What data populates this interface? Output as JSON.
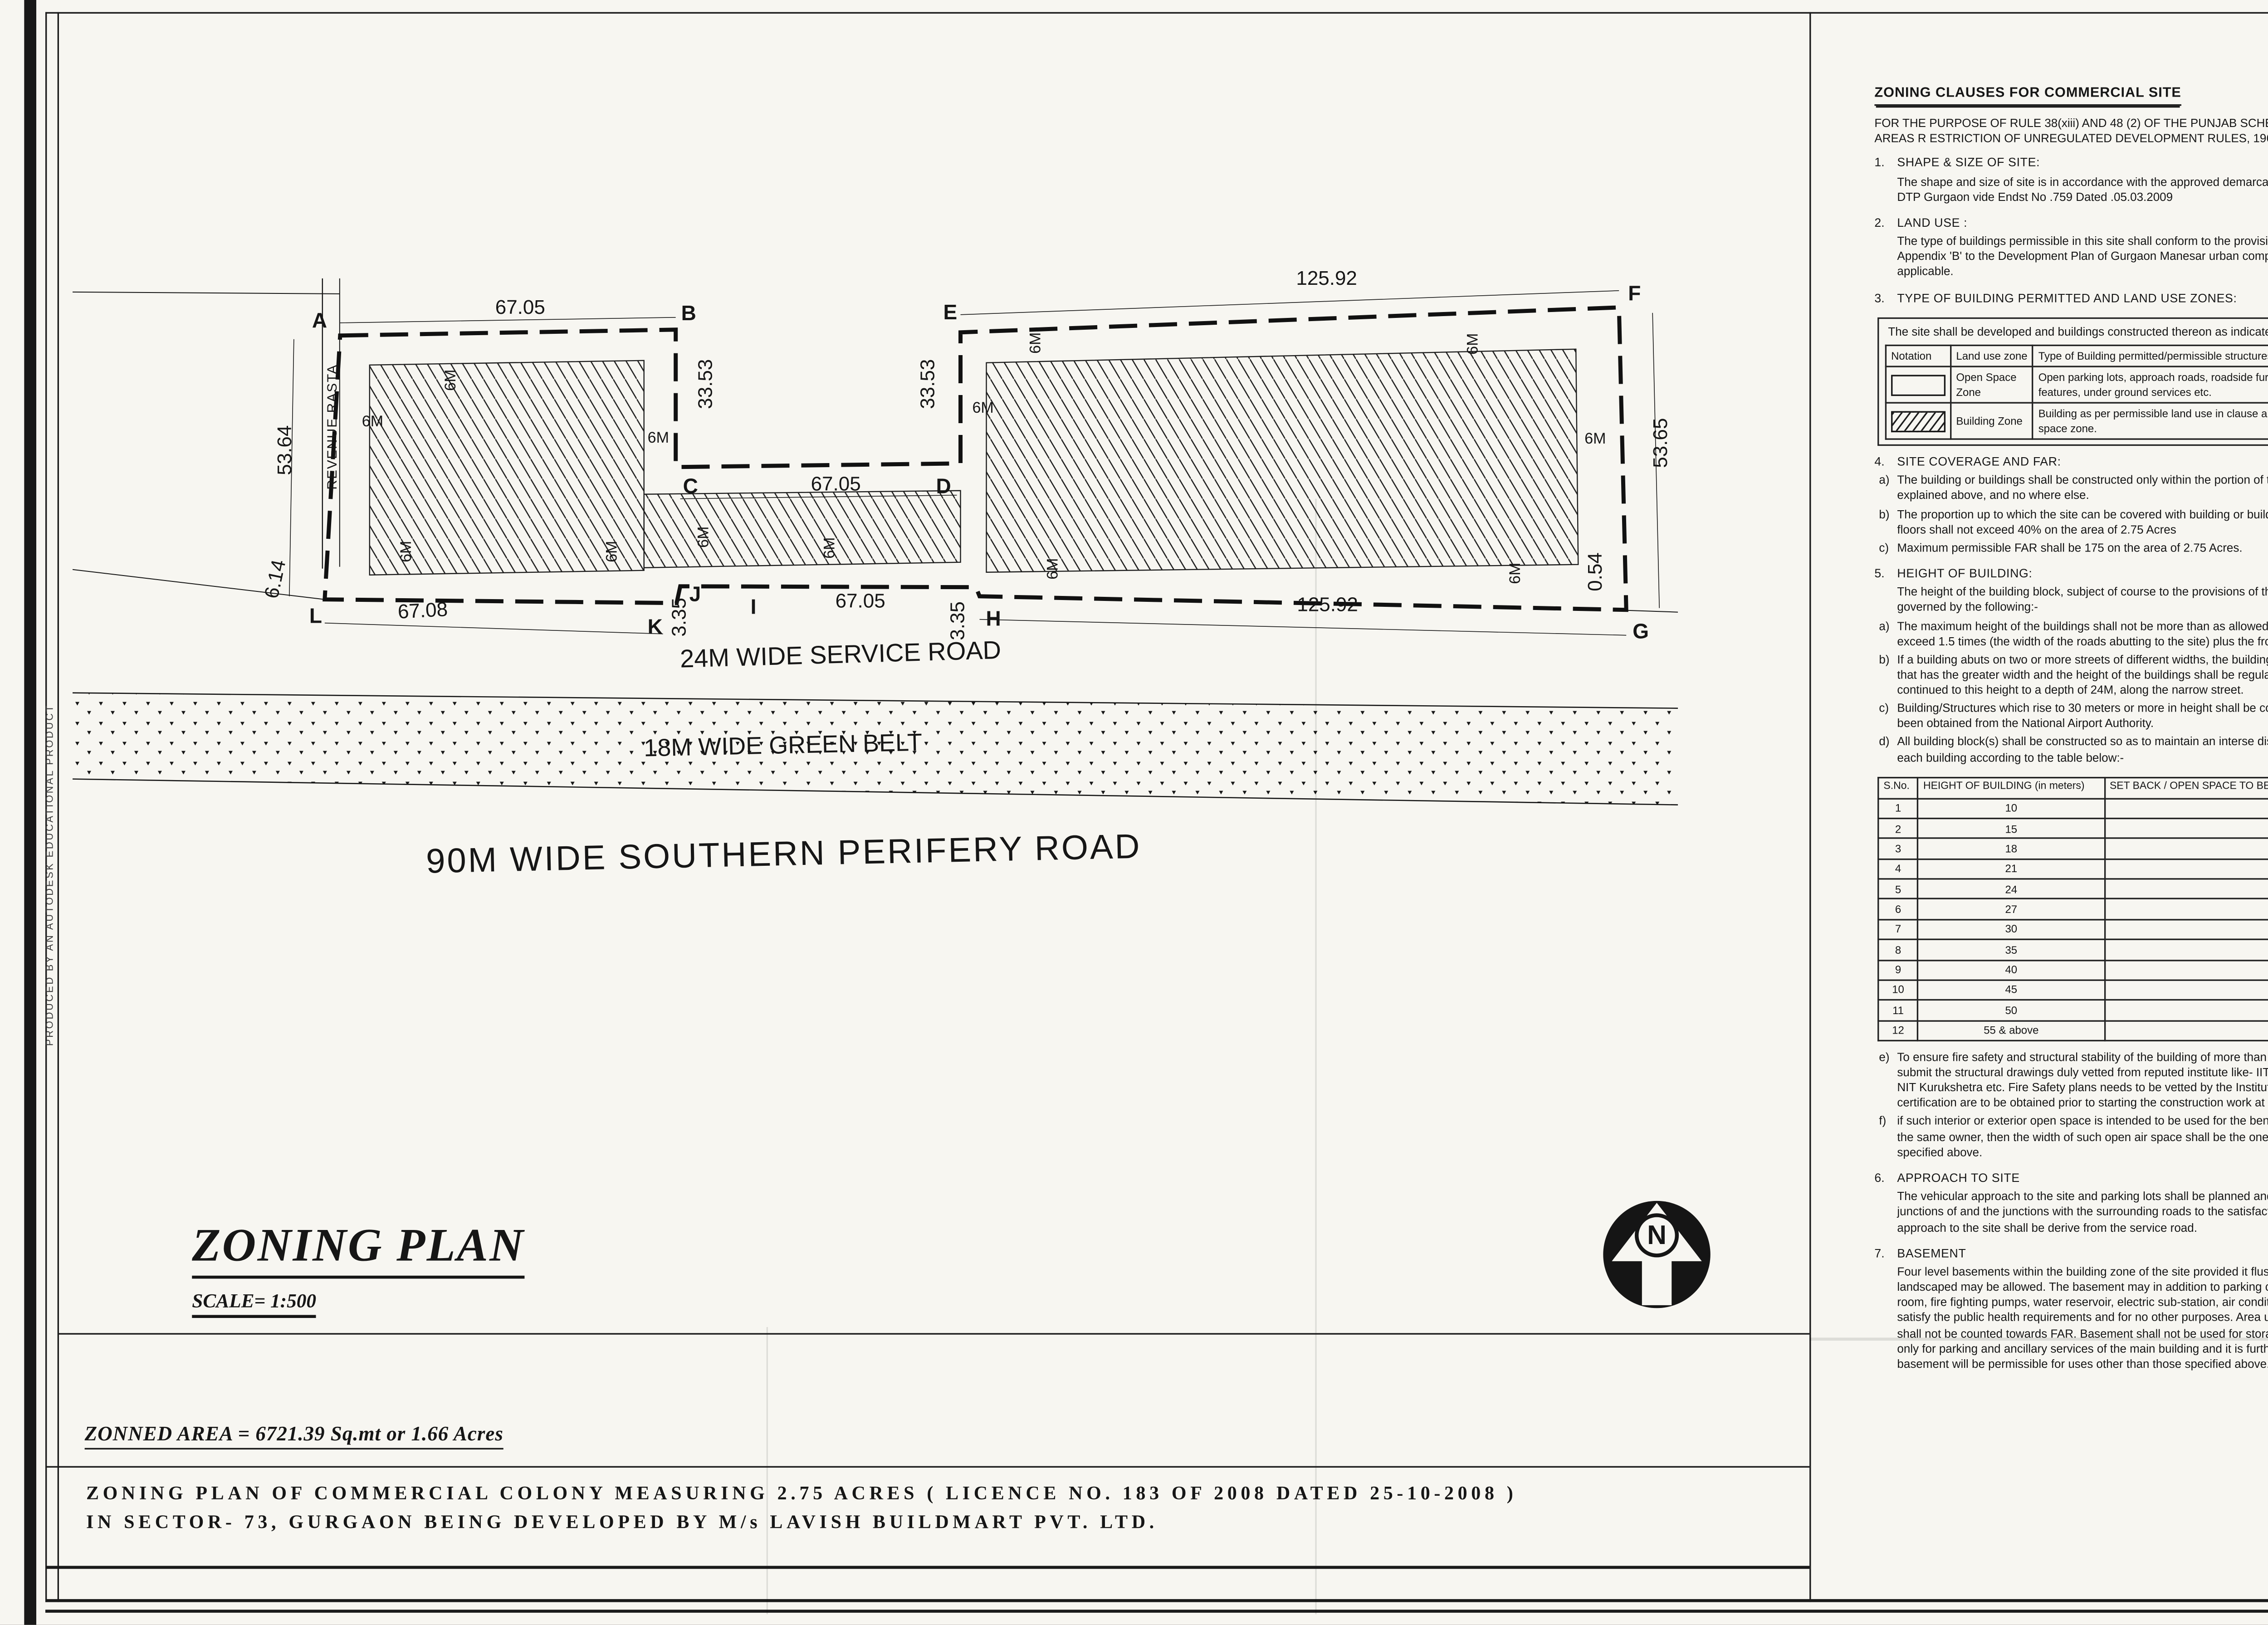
{
  "edge_note": "PRODUCED BY AN AUTODESK EDUCATIONAL PRODUCT",
  "title_block": {
    "title": "ZONING PLAN",
    "scale": "SCALE= 1:500",
    "zonned_area": "ZONNED AREA = 6721.39 Sq.mt or 1.66 Acres",
    "subtitle_line1": "ZONING PLAN OF COMMERCIAL COLONY MEASURING 2.75 ACRES ( LICENCE NO. 183 OF 2008 DATED 25-10-2008 )",
    "subtitle_line2": "IN SECTOR- 73, GURGAON BEING DEVELOPED BY M/s LAVISH BUILDMART PVT. LTD."
  },
  "plan": {
    "north_letter": "N",
    "revenue_rasta": "REVENUE RASTA",
    "road_service": "24M WIDE SERVICE ROAD",
    "road_green_belt": "18M WIDE GREEN BELT",
    "road_perifery": "90M WIDE SOUTHERN PERIFERY ROAD",
    "corners": [
      "A",
      "B",
      "C",
      "D",
      "E",
      "F",
      "G",
      "H",
      "I",
      "J",
      "K",
      "L"
    ],
    "dims": [
      "67.05",
      "125.92",
      "53.64",
      "53.65",
      "33.53",
      "33.53",
      "67.05",
      "67.05",
      "67.08",
      "125.92",
      "3.35",
      "3.35",
      "6.14",
      "0.54"
    ],
    "setback_label": "6M"
  },
  "clauses_title": "ZONING CLAUSES FOR COMMERCIAL SITE",
  "mid_flow": [
    {
      "type": "intro",
      "text": "FOR THE PURPOSE OF RULE 38(xiii) AND 48 (2) OF THE PUNJAB SCHEDULED ROADS AND CONTROLLED AREAS R ESTRICTION OF UNREGULATED DEVELOPMENT RULES, 1965."
    },
    {
      "type": "sec",
      "no": "1.",
      "title": "SHAPE & SIZE OF SITE:",
      "paras": [
        {
          "text": "The shape and size of site is in accordance with the approved demarcation plan shown as A to L. as confirmed by DTP Gurgaon vide  Endst No .759  Dated .05.03.2009"
        }
      ]
    },
    {
      "type": "sec",
      "no": "2.",
      "title": "LAND USE    :",
      "paras": [
        {
          "text": "The type of buildings permissible in this site shall conform to the provisions of the residential zone as provided in Appendix 'B' to the Development Plan of Gurgaon Manesar urban complex as amended from time to time, as applicable."
        }
      ]
    },
    {
      "type": "sec",
      "no": "3.",
      "title": "TYPE OF BUILDING PERMITTED AND LAND USE ZONES:",
      "paras": []
    },
    {
      "type": "landuse"
    },
    {
      "type": "sec",
      "no": "4.",
      "title": "SITE COVERAGE AND FAR:",
      "paras": [
        {
          "label": "a)",
          "text": "The building or buildings shall be constructed only within the portion of the site marked as Building zone as explained above, and no where else."
        },
        {
          "label": "b)",
          "text": "The proportion up to which the site can be covered with building or buildings on the ground floor and subsequent floors shall not exceed 40% on the area of 2.75 Acres"
        },
        {
          "label": "c)",
          "text": "Maximum permissible FAR shall be 175 on the area of 2.75 Acres."
        }
      ]
    },
    {
      "type": "sec",
      "no": "5.",
      "title": "HEIGHT OF BUILDING:",
      "paras": [
        {
          "text": "The height of the building block, subject of course to the provisions of the site coverage  and FAR, shall be governed by the following:-"
        },
        {
          "label": "a)",
          "text": "The maximum height of the buildings shall not be more than as allowed by National Airport Authority and shall not  exceed 1.5 times (the width of the roads abutting to the site) plus  the front open space."
        },
        {
          "label": "b)",
          "text": "If a building abuts on two or more streets of different widths, the buildings shall be  deemed to face upon the street that has the greater width and the height of the buildings  shall be regulated by the width of that street and may be continued to this height to a depth of 24M, along the narrow street."
        },
        {
          "label": "c)",
          "text": "Building/Structures which rise to 30 meters or more in height shall be constructed if no objection certificate has been obtained from the National Airport Authority."
        },
        {
          "label": "d)",
          "text": "All building block(s) shall be constructed so as to maintain an interse distance not less the set back required for each building according to the table below:-"
        }
      ]
    },
    {
      "type": "htable"
    },
    {
      "type": "sec",
      "paras": [
        {
          "label": "e)",
          "text": "To ensure fire safety and structural stability of the building of more than 60 meters in height,   the developer shall submit the structural drawings duly vetted from reputed institute like-  IIT Delhi, IIT Roorkee, PEC Chandigarh or NIT Kurukshetra etc. Fire Safety plans needs to be  vetted by the Institute of Fire Engineers at Nagpur.These certification are to be obtained prior  to starting the construction work at site."
        },
        {
          "label": "f)",
          "text": "if such interior or exterior open space is intended to be used for the benefit of more  than 'one building belonging to the same owner, then the width of such open air space  shall be the  one specified for the tallest building as specified above."
        }
      ]
    },
    {
      "type": "sec",
      "no": "6.",
      "title": "APPROACH TO SITE",
      "paras": [
        {
          "text": "The vehicular approach to the site and parking lots shall be planned and provided giving due  consideration to the junctions of and the junctions with the surrounding roads to the satisfaction of the DTCP, Haryana.  The permanent approach to the site shall be derive from the service road."
        }
      ]
    },
    {
      "type": "sec",
      "no": "7.",
      "title": "BASEMENT",
      "paras": [
        {
          "text": "Four level basements within the building zone of the site provided it flushes with the  ground and is properly landscaped may be allowed.  The basement may in addition to  parking could be utilized for generator room, lift room, fire fighting pumps, water  reservoir, electric sub-station, air conditioning plants and toilets/ utilities, if they satisfy the  public health requirements and for no other purposes. Area under stilts (only for parking) and basement  shall not be counted towards FAR.   Basement shall not be used for  storage/commercial purposes but will be used only for parking and ancillary services of the main building and it is further stipulated that no other partitions of basement will be permissible for uses other than those specified above."
        }
      ]
    }
  ],
  "landuse_note": "The site shall be developed and buildings constructed thereon as indicated in and explained in the table below:",
  "landuse_table": {
    "headers": [
      "Notation",
      "Land use zone",
      "Type of Building permitted/permissible structures."
    ],
    "rows": [
      {
        "swatch": "open",
        "zone": "Open Space Zone",
        "type": "Open parking lots, approach roads, roadside furniture, parks and play grounds, landscaping features, under ground services etc."
      },
      {
        "swatch": "hatch",
        "zone": "Building Zone",
        "type": "Building as per permissible land use in clause   above and uses permissible in the open space zone."
      }
    ]
  },
  "height_table": {
    "headers": [
      "S.No.",
      "HEIGHT OF BUILDING (in meters)",
      "SET BACK / OPEN SPACE TO BE LEFT AROUND BUILDINGS. (in meters)"
    ],
    "rows": [
      [
        "1",
        "10",
        "3"
      ],
      [
        "2",
        "15",
        "5"
      ],
      [
        "3",
        "18",
        "6"
      ],
      [
        "4",
        "21",
        "7"
      ],
      [
        "5",
        "24",
        "8"
      ],
      [
        "6",
        "27",
        "9"
      ],
      [
        "7",
        "30",
        "10"
      ],
      [
        "8",
        "35",
        "11"
      ],
      [
        "9",
        "40",
        "12"
      ],
      [
        "10",
        "45",
        "13"
      ],
      [
        "11",
        "50",
        "14"
      ],
      [
        "12",
        "55 & above",
        "16"
      ]
    ]
  },
  "right_flow": [
    {
      "type": "sec",
      "no": "9.",
      "title": "PARKING.",
      "paras": [
        {
          "label": "a.",
          "text": "Adequate parking spaces, covered, open or in the basement shall be provided for vehicles of users  and occupiers, within the site."
        },
        {
          "label": "b.",
          "text": "Atleast 15% of the parking shall be at the street level."
        },
        {
          "label": "c.",
          "text": "The parking spaces for commercial building shall not be less than 1ECS for 50 sqm. of covered area on all floors. The area for parking per car shall be as under:"
        },
        {
          "label": "(i)",
          "text": "Basement   =   35 sq. mtrs."
        },
        {
          "label": "(ii)",
          "text": "Stilts         =   30 sq. mtrs."
        },
        {
          "label": "(iii)",
          "text": "Open        =   25 sq. mtrs."
        },
        {
          "label": "d.",
          "text": "The covered parking in the basement or in the form of multi level parking above ground level shall not be counted towards FAR. However, in case of multi level parking above the ground level the foot print of separate parking building block shall be counted towards ground coverage. In case of provision of mechanical parking in the basement floor/ upperstories, the floor to ceiling height of the basement / upper  floor  may be maximum of 4.5 mtr. Other than the mechanical parking the floor to ceiling height in upper floor shall not be more than 2.4 mtr. below the hanging beam."
        },
        {
          "label": "e.",
          "text": "Not more than 25% of the parking space with in the shopping/commercial complex shall be allotted and this allotment shall be made only to the persons to whom shop/commercial space have been allotted. No parking space shall be allotted, leased out, sold or transferred in any manner to any  third party."
        }
      ]
    },
    {
      "type": "sec",
      "no": "9.",
      "title": "WIDTH/ SLOPE OF RAMP.",
      "paras": [
        {
          "text": "The clear width of the ramp leading to the basement floor shall be minimum 4 mtrs. with an adequate slope not steeper than 1:10. The entry and exit shall be separete preferably at opposite ends."
        }
      ]
    },
    {
      "type": "sec",
      "no": "10.",
      "title": "PLANNING NORMS",
      "paras": [
        {
          "text": "The building/buildings to be constructed shall be planned and designed to the norms and standards as approved by DTCP, Haryana."
        }
      ]
    },
    {
      "type": "sec",
      "no": "11.",
      "title": "PROVISIONS OF PUBLIC HEALTH FACILITIES.",
      "paras": [
        {
          "text": "The W.C. and urinals provided in the buildings shall conform to the National Building Code/Act No. 41  of 1963 and rules f ramed there under."
        }
      ]
    },
    {
      "type": "sec",
      "no": "12.",
      "title": "SUB DIVISIONS OF SITE",
      "paras": [
        {
          "text": "No sub division of the Commercial Colony shall be permitted."
        }
      ]
    },
    {
      "type": "sec",
      "no": "13.",
      "title": "WIDTH OF COVERED PUBLIC CORRIDOR",
      "paras": [
        {
          "text": "A covered public corridor should have a minimum clear width of 8'- 3\".  However, in case of offices on subsequent floor, the width of the corridor would be governed by Rule 82 of the Rules, 1965."
        }
      ]
    },
    {
      "type": "sec",
      "no": "14.",
      "title": "EXTERNAL FINISHES",
      "paras": [
        {
          "label": "a)",
          "text": "The external wall finishes, so far as possible shall be in natural or permanent type of materials like  bricks, stone, concrete, terracotta, grits, marble,  chips, glass, metals or any other finish which may  be allowed by the DTCP."
        },
        {
          "label": "b)",
          "text": "The water storage tanks and plumbing works shall not be visible on any face of the building and  shall be suitable encased."
        },
        {
          "label": "c)",
          "text": "All sign boards and names shall be written on the spaces pr ovided on buildings as per approved buildings plans specifically for this purpose and at no other places, whatsoever."
        }
      ]
    },
    {
      "type": "sec",
      "no": "15.",
      "title": "APPROVAL OF BUILDING PLANS",
      "paras": [
        {
          "text": "The building plans of the buildings to be constructed at site shall have to be got approved from the DTCP,  Haryana (under section 8(2) of the Act No.41 of 1963), before taking up the construction."
        }
      ]
    },
    {
      "type": "sec",
      "no": "16.",
      "title": "BUILDING BYE- LAWS:",
      "paras": [
        {
          "text": "The construction of the building/buildings shall be governed by the building rules provided in part  Controlled Areas, Restriction of Unregulated Development  VII of the Punjab Schaduled Roads and   1987 regarding provisions for Physically Handicapped Persons.On  Rules, 1965 and IS Code No. 4963- the points where such rules are silent and stipulate no condition or norm, the model building byelaw issued by the ISI, and as given in the NBC shall be followed as may be approved by DTCP, Haryana."
        }
      ]
    },
    {
      "type": "sec",
      "no": "17.",
      "title": "FIRE SAFETY MEASURES:",
      "paras": [
        {
          "label": "a)",
          "text": "The owner will ensure the provision of proper fire safety measures in the multi storeyed buildings conforming to the provisions of  Rules 1965/ NBC and the same should be got certified from the  competent authority."
        },
        {
          "label": "b)",
          "text": "Electric Sub Station / generator room if provided should be on solid ground near DG/LT. Control   periphery of the  panel on ground floor or in upper basement and it should be located on outer building, the same should be got approved from the Chief Electrical inspector Haryana."
        }
      ]
    },
    {
      "type": "sec",
      "no": "18.",
      "title": "SOLAR WATER HEATING SYSTEM",
      "paras": [
        {
          "text": "The provision of solar water heating system shall be as per norms specified by HAREDA  and shall be made operational in each building block (if hot water is required) before applying for an occupation certificate."
        }
      ]
    },
    {
      "type": "sec",
      "no": "19.",
      "title": "RAIN WATER HARVESTING SYSTEM",
      "paras": [
        {
          "text": "The rain water harvesting system shall be provided as per Central Ground Water Authority norms/Haryana Govt. notification as applicable."
        }
      ]
    },
    {
      "type": "sec",
      "no": "20",
      "paras": [
        {
          "text": "The coloniser shall obtain the clearance/NOC as per the provisions of the Notification  No. S.O. 1533 (E) Dated 14.9.2006 issued by Ministry of Environment and Forest,  Government of India before starting the construction/ execution of development  works at site."
        }
      ]
    },
    {
      "type": "sec",
      "no": "21.",
      "paras": [
        {
          "text": "The coloniser/owner shall use only Compact Fluorescent Lamps fittings for internal lighting as  well as campus lighting."
        }
      ]
    },
    {
      "type": "sec",
      "no": "22.",
      "paras": [
        {
          "text": "The coloniser shall convey the ultimate power load requirement of the project to the concerned . power utility to enable the provision of project to the concerned site for transformer/switchingstation /electric  sub station as per the norms prescribed by the power utility in the project site before submission of Building plan not later then 2 months from the approval of zoning plan."
        }
      ]
    }
  ],
  "drg": {
    "prefix": "DRG. NO. D.T.C.P.",
    "number": "1850",
    "dated_label": "DATED",
    "date": "8/4/09"
  },
  "signatures": [
    {
      "name": "(F.P .SINGH)",
      "role": "DTP(HQ)"
    },
    {
      "name": "(DHARE SINGH)",
      "role": "CTP(HR)"
    },
    {
      "name": "(S.S. DHILLON)",
      "role": "D.T.C.P (HR)"
    }
  ]
}
